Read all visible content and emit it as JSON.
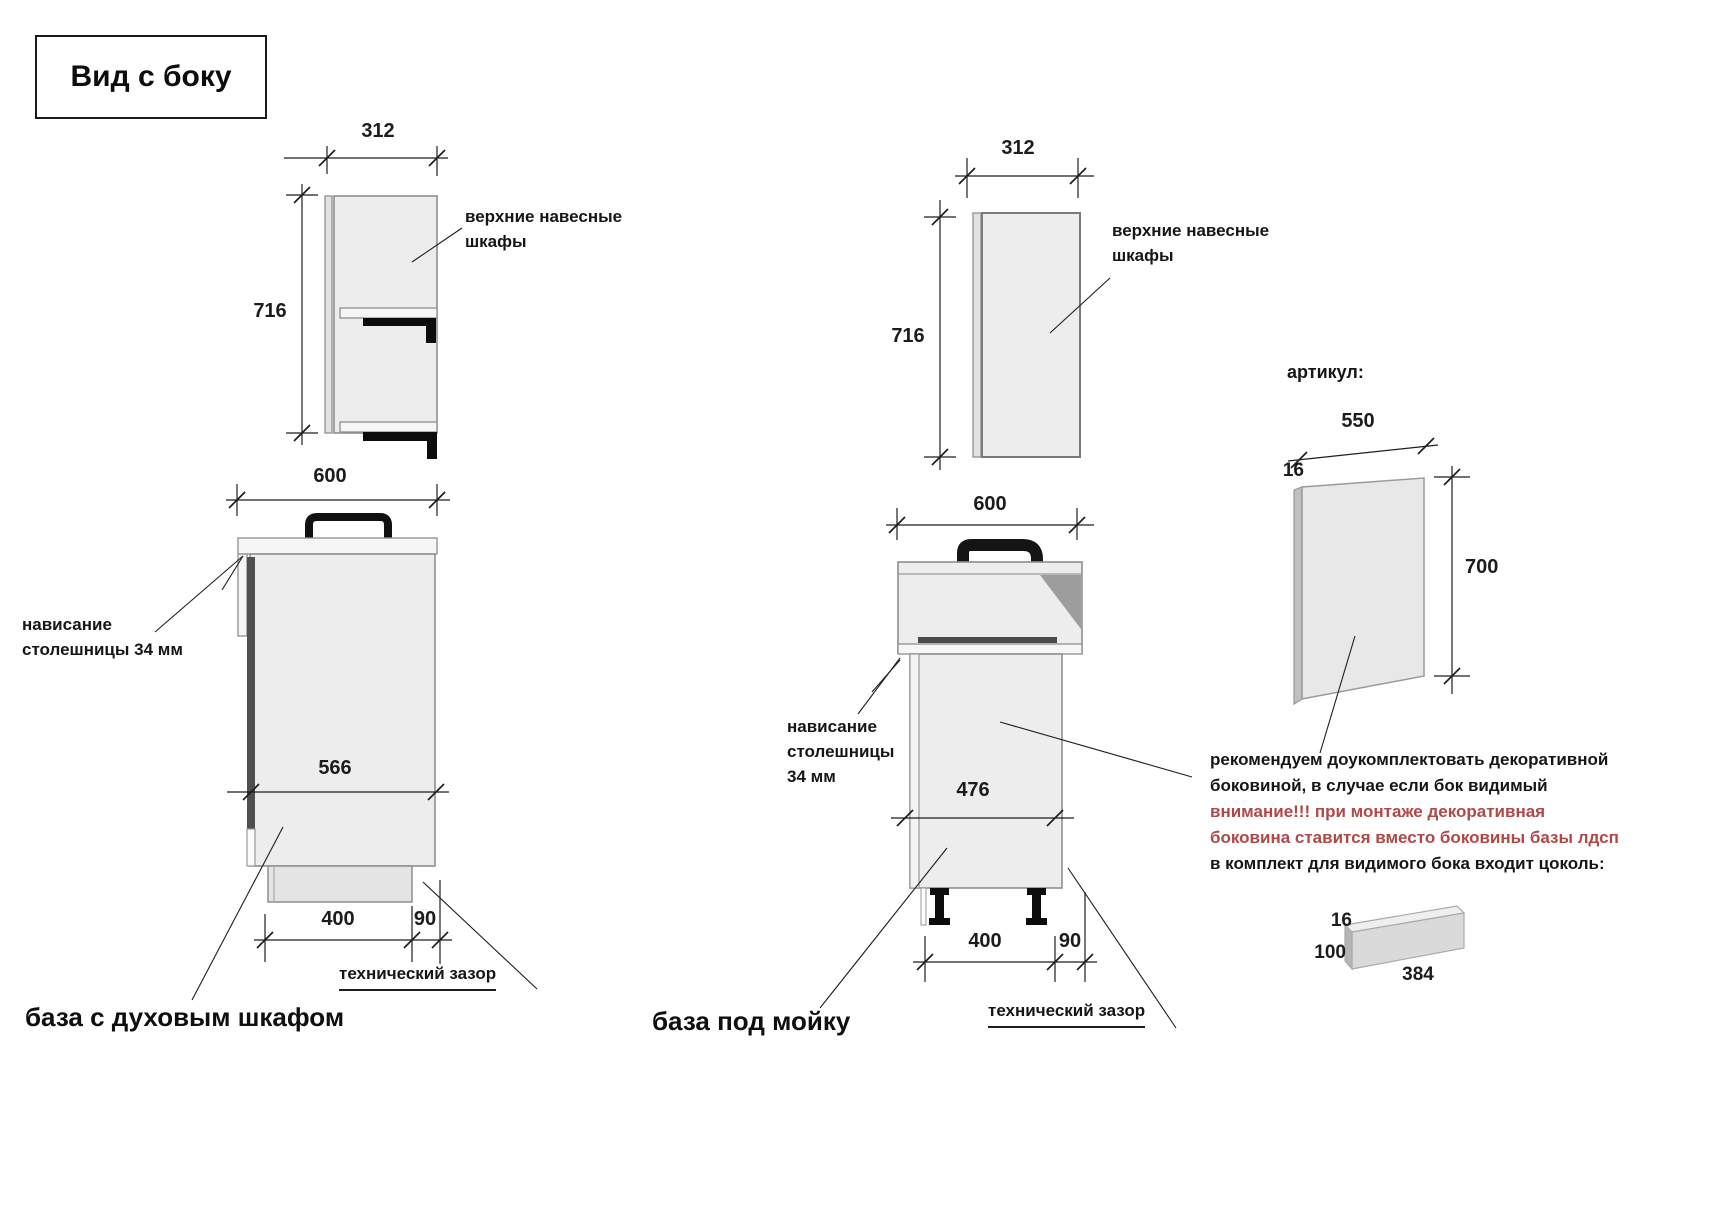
{
  "title": "Вид с боку",
  "wall_cabinet_left": {
    "width": "312",
    "height": "716",
    "callout_line1": "верхние навесные",
    "callout_line2": "шкафы"
  },
  "oven_base": {
    "top_width": "600",
    "body_depth": "566",
    "plinth_depth": "400",
    "tech_gap": "90",
    "tech_gap_label": "технический зазор",
    "overhang_line1": "нависание",
    "overhang_line2": "столешницы 34 мм",
    "caption": "база с духовым шкафом"
  },
  "wall_cabinet_mid": {
    "width": "312",
    "height": "716",
    "callout_line1": "верхние навесные",
    "callout_line2": "шкафы"
  },
  "sink_base": {
    "top_width": "600",
    "body_depth": "476",
    "plinth_depth": "400",
    "tech_gap": "90",
    "tech_gap_label": "технический зазор",
    "overhang_line1": "нависание",
    "overhang_line2": "столешницы",
    "overhang_line3": "34 мм",
    "caption": "база под мойку"
  },
  "decor_panel": {
    "heading": "артикул:",
    "width": "550",
    "thickness": "16",
    "height": "700",
    "note_line1": "рекомендуем доукомплектовать декоративной",
    "note_line2": "боковиной, в случае если бок видимый",
    "warning_line1": "внимание!!! при монтаже декоративная",
    "warning_line2": "боковина ставится вместо боковины базы лдсп",
    "note_line3": "в комплект для видимого бока входит цоколь:"
  },
  "plinth_part": {
    "thickness": "16",
    "height": "100",
    "length": "384"
  },
  "colors": {
    "warning_text": "#b04848",
    "line": "#1e1e1e",
    "cabinet_fill": "#ededed"
  }
}
